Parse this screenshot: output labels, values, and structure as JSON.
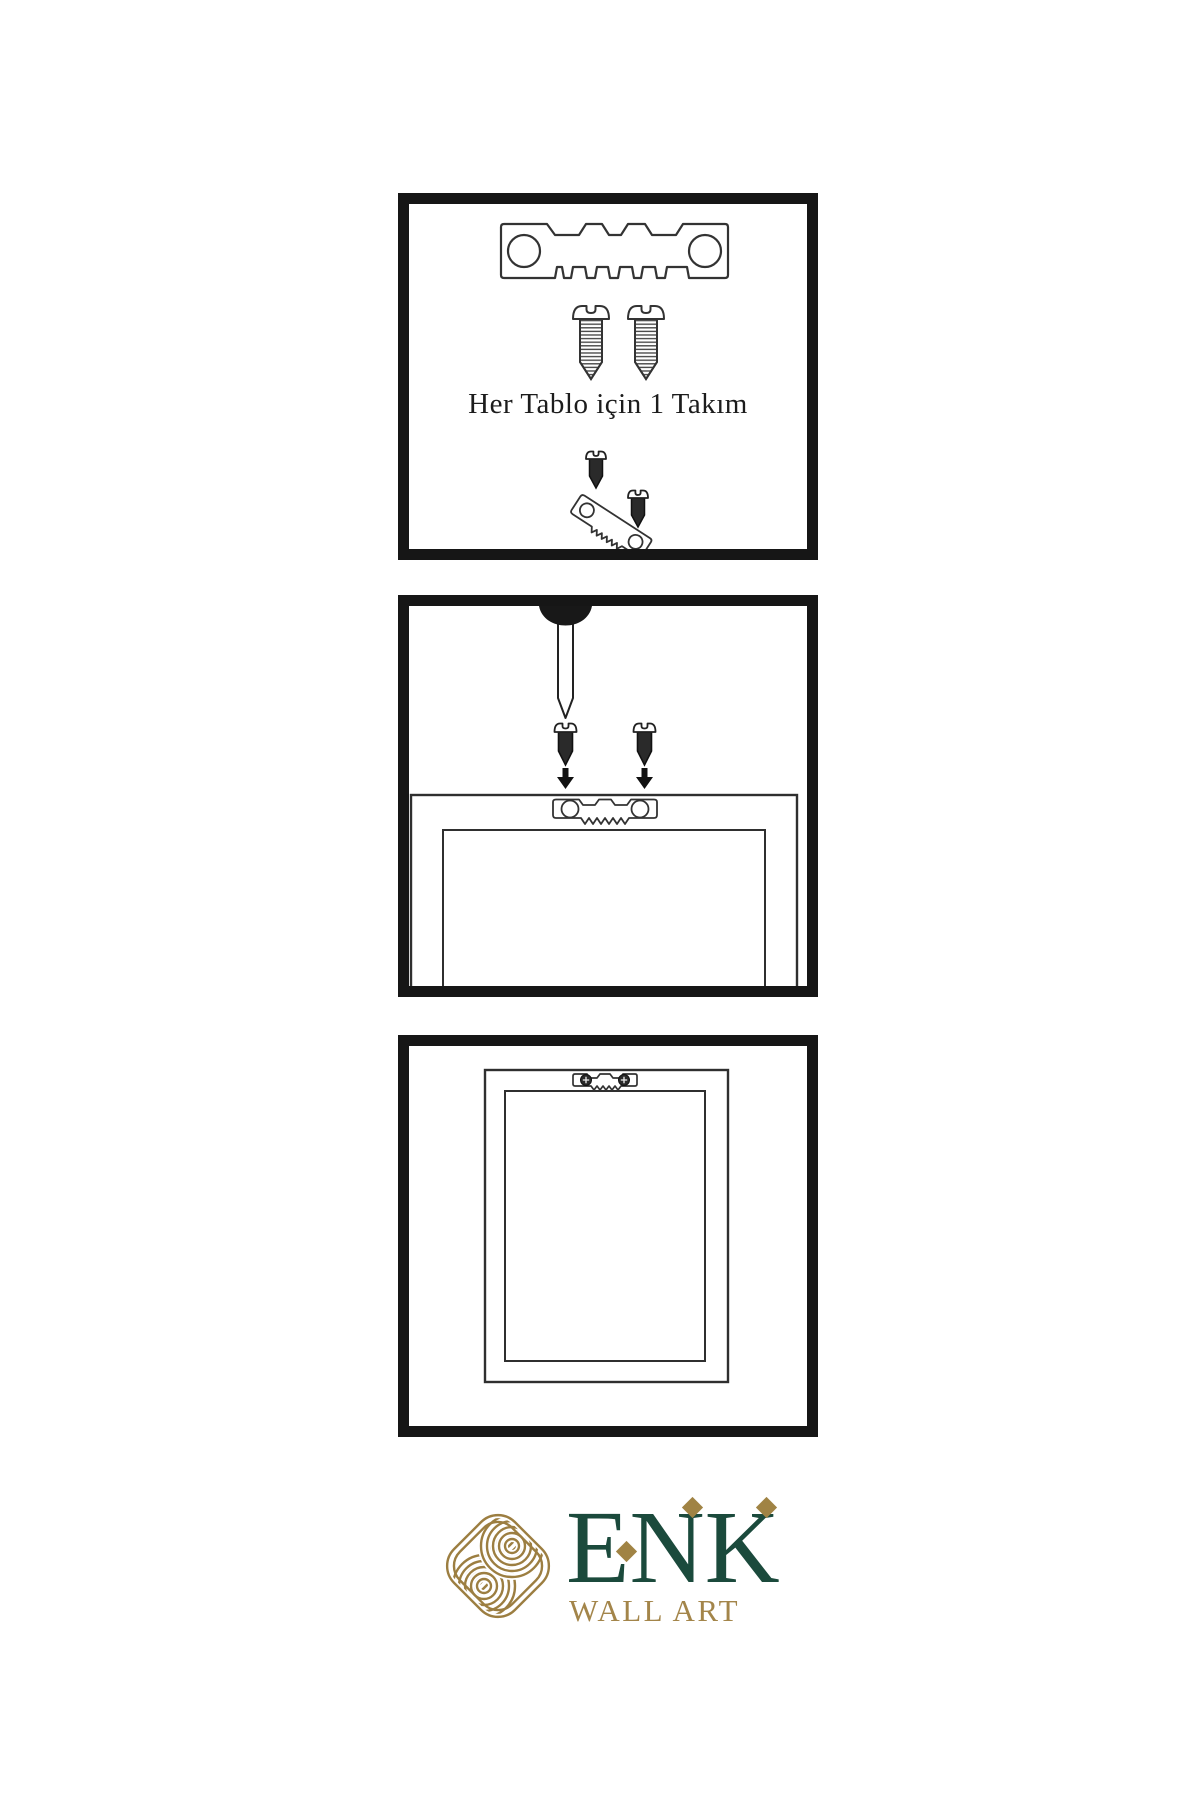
{
  "instructions": {
    "step1": {
      "caption": "Her Tablo için 1 Takım",
      "items": [
        "sawtooth-hanger-plate",
        "mounting-screw",
        "mounting-screw",
        "mini-sawtooth-hanger-with-screws"
      ]
    },
    "step2": {
      "items": [
        "wall-nail",
        "dark-screw",
        "dark-screw",
        "down-arrow",
        "down-arrow",
        "frame-back-with-sawtooth-hanger"
      ]
    },
    "step3": {
      "items": [
        "hanging-frame-with-mounted-sawtooth-hanger"
      ]
    }
  },
  "logo": {
    "brand": "ENK",
    "tagline": "WALL ART",
    "mark": "interlaced-knot",
    "brand_color": "#1b4a3c",
    "accent_color": "#9c7e41"
  },
  "colors": {
    "background": "#ffffff",
    "panel_border": "#161616",
    "diagram_line": "#2f2f2f",
    "screw_dark": "#2a2a2a"
  }
}
